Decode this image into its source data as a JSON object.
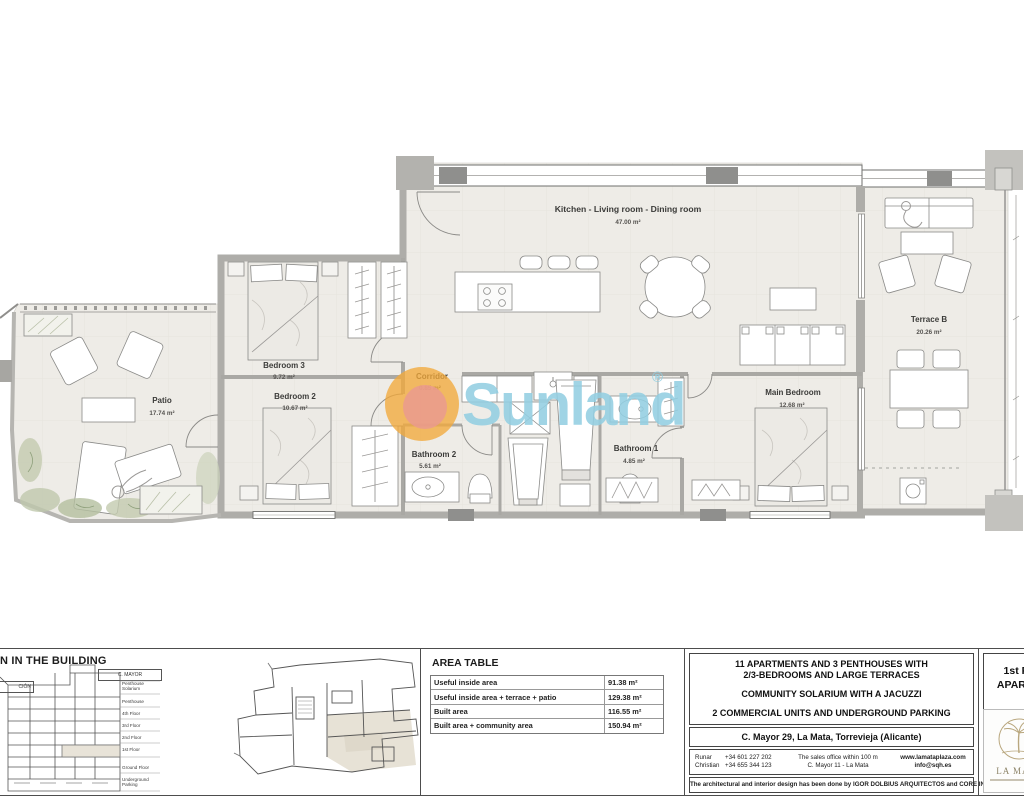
{
  "watermark": {
    "brand": "Sunland",
    "registered": "®"
  },
  "plan": {
    "rooms": {
      "kitchen": {
        "name": "Kitchen - Living room - Dining room",
        "area": "47.00 m²"
      },
      "corridor": {
        "name": "Corridor",
        "area": "0.85 m²"
      },
      "bedroom3": {
        "name": "Bedroom 3",
        "area": "9.72 m²"
      },
      "bedroom2": {
        "name": "Bedroom 2",
        "area": "10.67 m²"
      },
      "patio": {
        "name": "Patio",
        "area": "17.74 m²"
      },
      "bathroom2": {
        "name": "Bathroom 2",
        "area": "5.61 m²"
      },
      "bathroom1": {
        "name": "Bathroom 1",
        "area": "4.85 m²"
      },
      "main_bedroom": {
        "name": "Main Bedroom",
        "area": "12.68 m²"
      },
      "terrace": {
        "name": "Terrace B",
        "area": "20.26 m²"
      }
    }
  },
  "titleblock": {
    "building_section": {
      "title": "N IN THE BUILDING",
      "street_box": "C. MAYOR",
      "left_box": "CIÓN",
      "floors": [
        "Penthouse Solarium",
        "Penthouse",
        "4th Floor",
        "3rd Floor",
        "2nd Floor",
        "1st Floor",
        "Ground Floor",
        "Underground Parking"
      ]
    },
    "area_table": {
      "title": "AREA TABLE",
      "rows": [
        {
          "label": "Useful inside area",
          "value": "91.38 m²"
        },
        {
          "label": "Useful inside area + terrace + patio",
          "value": "129.38 m²"
        },
        {
          "label": "Built area",
          "value": "116.55 m²"
        },
        {
          "label": "Built area + community area",
          "value": "150.94 m²"
        }
      ]
    },
    "project": {
      "headline1": "11 APARTMENTS AND 3 PENTHOUSES WITH",
      "headline2": "2/3-BEDROOMS AND LARGE TERRACES",
      "headline3": "COMMUNITY SOLARIUM WITH A JACUZZI",
      "headline4": "2 COMMERCIAL UNITS AND UNDERGROUND PARKING",
      "address": "C. Mayor 29, La Mata, Torrevieja (Alicante)",
      "contact_name1": "Runar",
      "contact_phone1": "+34 601 227 202",
      "contact_name2": "Christian",
      "contact_phone2": "+34 655 344 123",
      "office_line1": "The sales office within 100 m",
      "office_line2": "C. Mayor 11 - La Mata",
      "web": "www.lamataplaza.com",
      "email": "info@sqh.es",
      "credit": "The architectural and interior design has been done by  IGOR DOLBIUS ARQUITECTOS and CORE INTERIORISMO"
    },
    "sheet": {
      "line1": "1st FL",
      "line2": "APARTM",
      "logo_text": "LA MATA"
    }
  }
}
